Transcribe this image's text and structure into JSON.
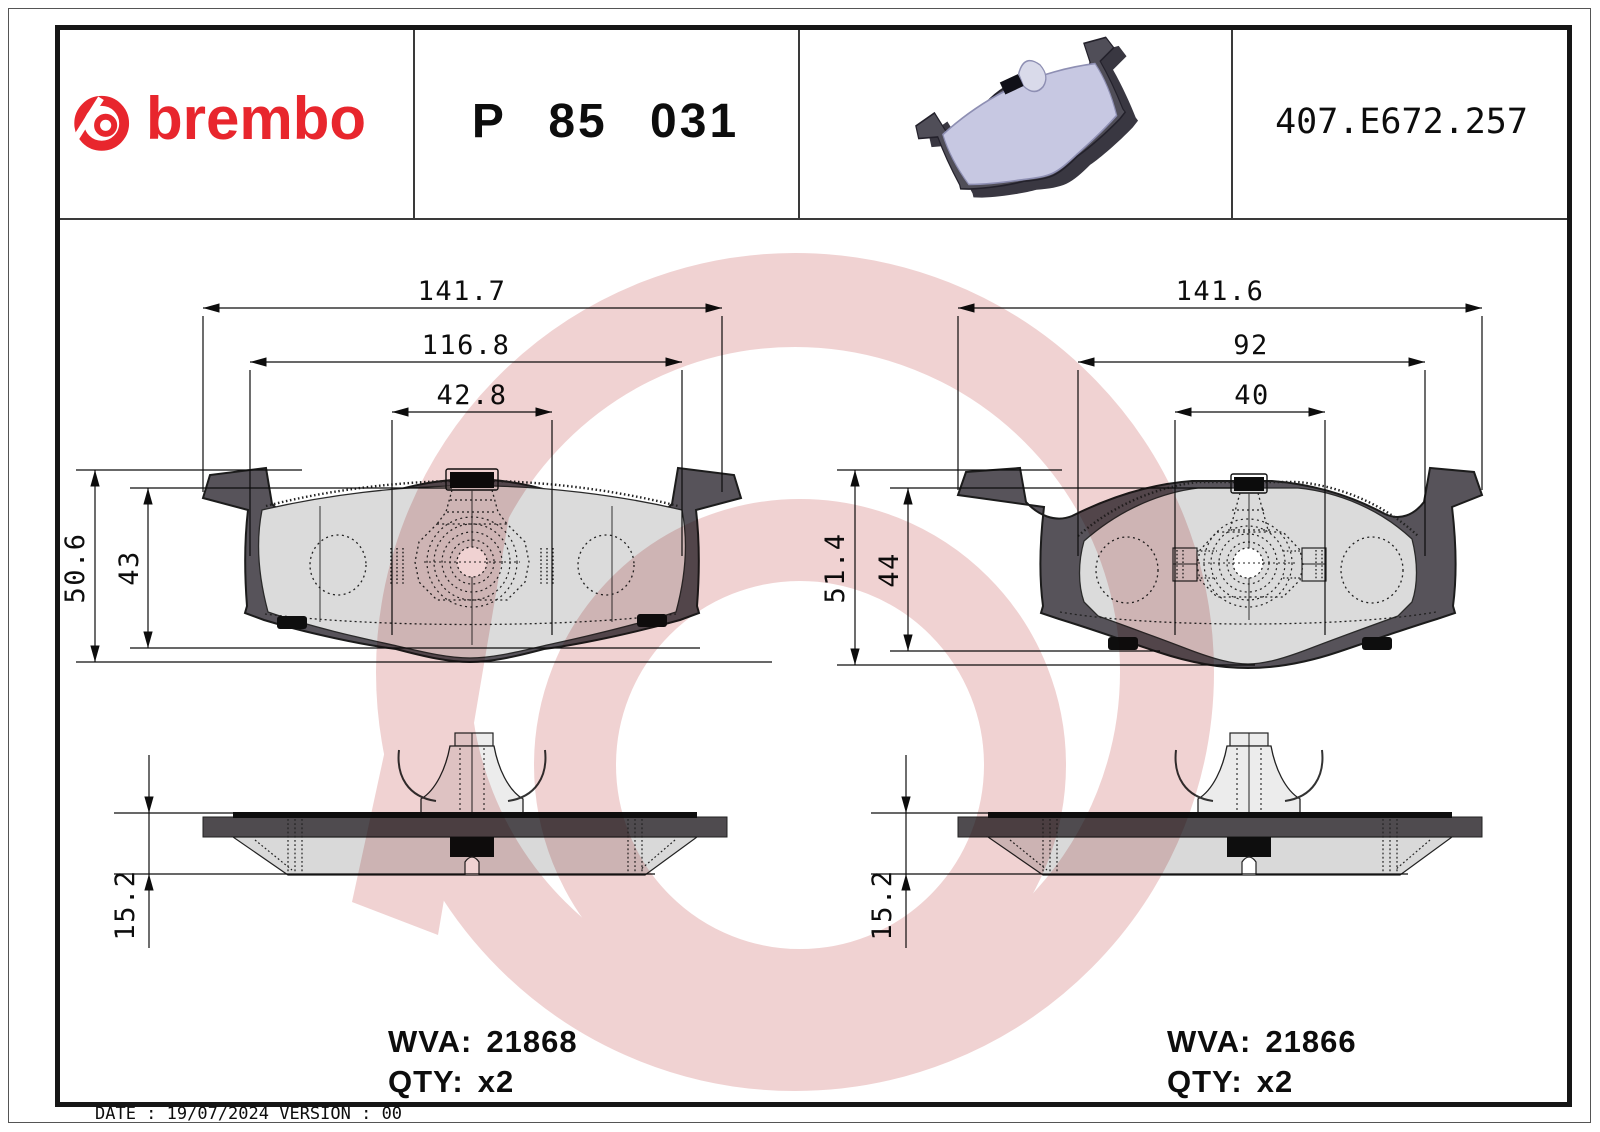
{
  "header": {
    "brand_wordmark": "brembo",
    "part_number": "P 85 031",
    "reference_code": "407.E672.257"
  },
  "left_drawing": {
    "dims": {
      "overall_width": "141.7",
      "pad_width": "116.8",
      "center_width": "42.8",
      "overall_height": "50.6",
      "pad_height": "43",
      "thickness": "15.2"
    },
    "wva_label": "WVA:",
    "wva_value": "21868",
    "qty_label": "QTY:",
    "qty_value": "x2"
  },
  "right_drawing": {
    "dims": {
      "overall_width": "141.6",
      "pad_width": "92",
      "center_width": "40",
      "overall_height": "51.4",
      "pad_height": "44",
      "thickness": "15.2"
    },
    "wva_label": "WVA:",
    "wva_value": "21866",
    "qty_label": "QTY:",
    "qty_value": "x2"
  },
  "footer": {
    "date_text": "DATE : 19/07/2024 VERSION : 00"
  },
  "colors": {
    "brand_red": "#E8262D",
    "watermark_pink": "#DA8F8F",
    "plate_gray": "#57535A",
    "pad_face_gray": "#DBDBDB",
    "render_lavender": "#C7C8E2"
  }
}
